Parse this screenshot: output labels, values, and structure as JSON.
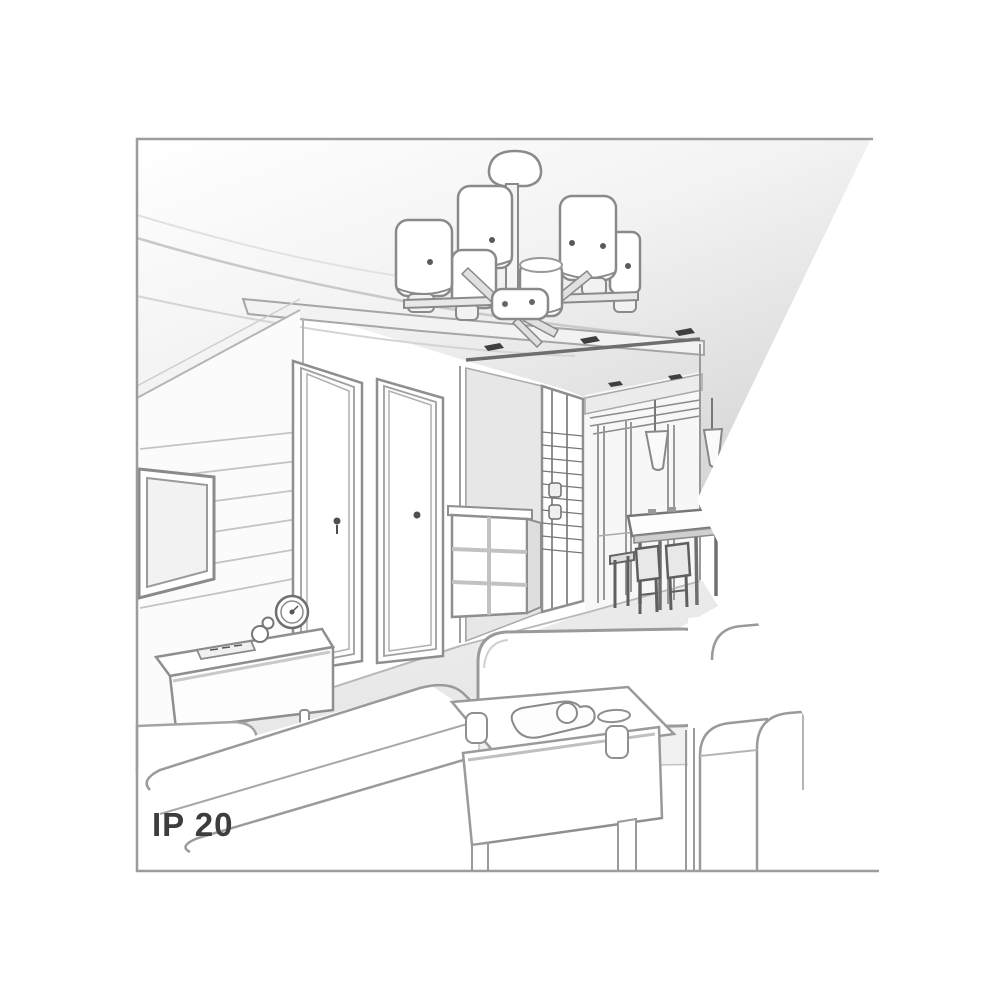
{
  "meta": {
    "type": "interior-line-drawing",
    "description": "Grayscale perspective sketch of a living room interior with a six-shade ceiling chandelier; right side of the picture is clipped by a white wedge",
    "background": "#ffffff"
  },
  "badge": {
    "ip_rating": "IP 20"
  },
  "colors": {
    "background": "#ffffff",
    "frame_border": "#9c9c9c",
    "line": "#8f8f8f",
    "line_dark": "#4f4f4f",
    "ceiling_shade": "#d8d8d8",
    "floor_shade": "#e9e9e9",
    "spotlight_dark": "#3f3f3f",
    "text": "#3d3d3d"
  },
  "scene": {
    "objects": [
      "ceiling-chandelier-six-shades",
      "ceiling-canopy",
      "suspended-ceiling-band",
      "recessed-spotlights",
      "paneled-tv-wall",
      "wall-tv",
      "tv-stand",
      "remote-control",
      "figurine",
      "table-clock",
      "interior-door-left",
      "interior-door-right",
      "chest-of-drawers",
      "wardrobe-grid-doors",
      "hallway",
      "dining-drop-ceiling",
      "pendant-cone-lamps",
      "dining-table",
      "dining-chairs",
      "sofa-left",
      "sofa-center",
      "sofa-right",
      "coffee-table",
      "serving-tray",
      "cups",
      "white-wedge-cutout",
      "picture-frame"
    ]
  }
}
